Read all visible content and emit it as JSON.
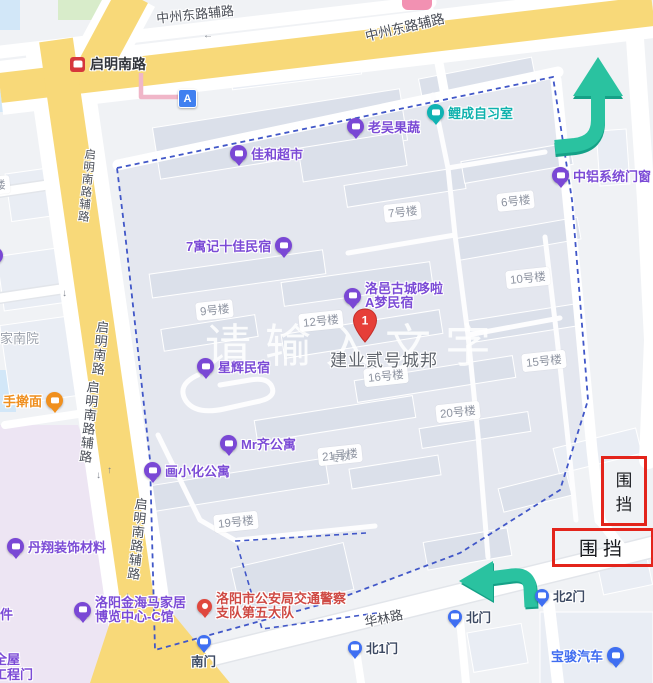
{
  "watermark": "请输入文字",
  "roads": {
    "zhongzhou_top_left": "中州东路辅路",
    "zhongzhou_top_right": "中州东路辅路",
    "qiming_station": "启明南路",
    "qiming_fulu_upper": "启明南路辅路",
    "qiming_main": "启明南路",
    "qiming_fulu_mid": "启明南路辅路",
    "qiming_fulu_lower": "启明南路辅路",
    "hualin": "华林路"
  },
  "marker": {
    "name": "建业贰号城邦",
    "badge": "1"
  },
  "point_a": {
    "label": "A"
  },
  "pois": {
    "jiahe": {
      "label": "佳和超市"
    },
    "laowu": {
      "label": "老吴果蔬"
    },
    "licheng": {
      "label": "鲤成自习室"
    },
    "zhonglv": {
      "label": "中铝系统门窗"
    },
    "qiyuji": {
      "label": "7寓记十佳民宿"
    },
    "luoyi_line1": "洛邑古城哆啦",
    "luoyi_line2": "A梦民宿",
    "xinghui": {
      "label": "星辉民宿"
    },
    "mrqi": {
      "label": "Mr齐公寓"
    },
    "huaxiaohua": {
      "label": "画小化公寓"
    },
    "danxiang": {
      "label": "丹翔装饰材料"
    },
    "shouganmian": {
      "label": "手擀面"
    },
    "jinhaima_line1": "洛阳金海马家居",
    "jinhaima_line2": "博览中心-C馆",
    "police_line1": "洛阳市公安局交通警察",
    "police_line2": "支队第五大队",
    "baojun": {
      "label": "宝骏汽车"
    },
    "partial_jia": "家",
    "partial_jianany": "家南院",
    "partial_jian": "件",
    "partial_quanwu": "全屋",
    "partial_gongchengmen": "工程门",
    "partial_zhuanxiao": "专校",
    "partial_lou": "楼"
  },
  "gates": {
    "south": "南门",
    "north": "北门",
    "north1": "北1门",
    "north2": "北2门"
  },
  "buildings": {
    "b7": "7号楼",
    "b6": "6号楼",
    "b9": "9号楼",
    "b10": "10号楼",
    "b12": "12号楼",
    "b15": "15号楼",
    "b16": "16号楼",
    "b19": "19号楼",
    "b20": "20号楼",
    "b21": "21号楼"
  },
  "barriers": {
    "vertical": "围挡",
    "horizontal": "围挡"
  },
  "colors": {
    "boundary": "#4157c8",
    "road_yellow": "#f8d979",
    "arrow": "#2ac2a0",
    "barrier_border": "#e3241b",
    "poi_purple": "#7b4bd6",
    "pin_red": "#e63f38"
  }
}
